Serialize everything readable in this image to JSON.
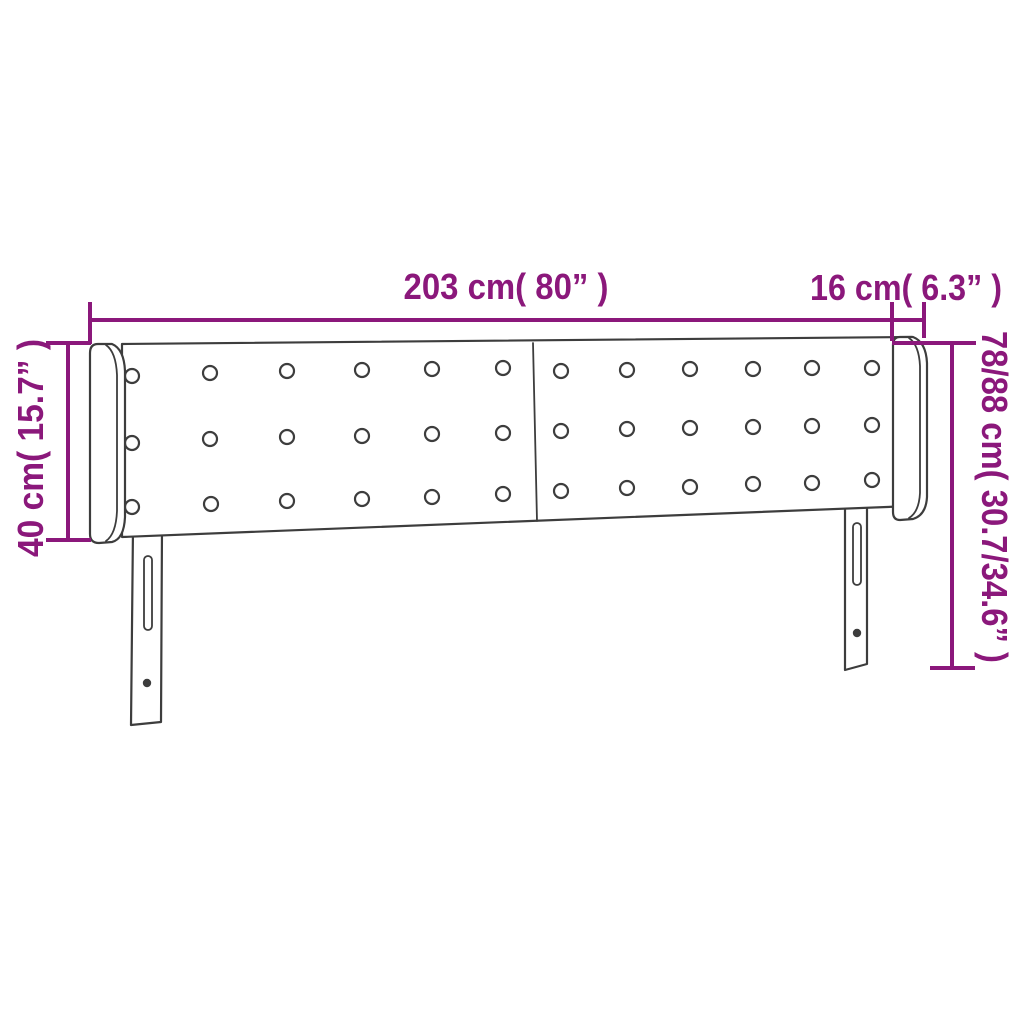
{
  "page": {
    "background_color": "#ffffff"
  },
  "diagram": {
    "subject": "headboard-with-wings-dimension-diagram",
    "colors": {
      "dimension_color": "#8b187b",
      "outline_color": "#3d3d3d"
    },
    "dimensions": {
      "total_width": {
        "label": "203 cm( 80” )"
      },
      "wing_width": {
        "label": "16 cm( 6.3” )"
      },
      "upholstery_height": {
        "label": "40 cm( 15.7” )"
      },
      "total_height": {
        "label": "78/88 cm( 30.7/34.6” )"
      }
    },
    "tufting_buttons": {
      "radius": 7,
      "positions": [
        [
          132,
          376
        ],
        [
          210,
          373
        ],
        [
          287,
          371
        ],
        [
          362,
          370
        ],
        [
          432,
          369
        ],
        [
          503,
          368
        ],
        [
          132,
          443
        ],
        [
          210,
          439
        ],
        [
          287,
          437
        ],
        [
          362,
          436
        ],
        [
          432,
          434
        ],
        [
          503,
          433
        ],
        [
          132,
          507
        ],
        [
          211,
          504
        ],
        [
          287,
          501
        ],
        [
          362,
          499
        ],
        [
          432,
          497
        ],
        [
          503,
          494
        ],
        [
          561,
          371
        ],
        [
          627,
          370
        ],
        [
          690,
          369
        ],
        [
          753,
          369
        ],
        [
          812,
          368
        ],
        [
          872,
          368
        ],
        [
          561,
          431
        ],
        [
          627,
          429
        ],
        [
          690,
          428
        ],
        [
          753,
          427
        ],
        [
          812,
          426
        ],
        [
          872,
          425
        ],
        [
          561,
          491
        ],
        [
          627,
          488
        ],
        [
          690,
          487
        ],
        [
          753,
          484
        ],
        [
          812,
          483
        ],
        [
          872,
          480
        ]
      ]
    }
  }
}
